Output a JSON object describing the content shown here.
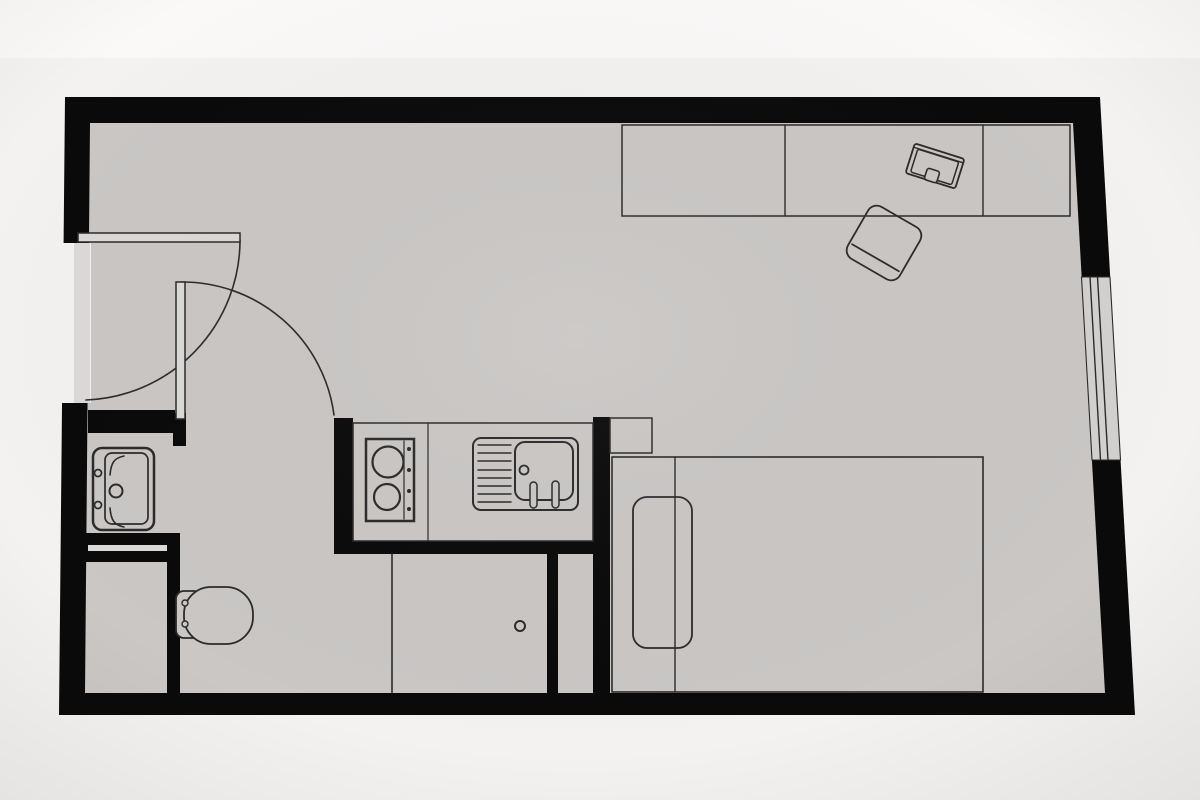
{
  "page": {
    "kind": "floor-plan-drawing",
    "text_content": "none"
  },
  "colors": {
    "background": "#f4f2f0",
    "backgroundTop": "#fbfaf9",
    "floor": "#cac7c5",
    "floorLight": "#dcdad8",
    "wall": "#0a0a0a",
    "line": "#2b2b2b",
    "windowGlass": "#d3d1cf"
  },
  "plan": {
    "rooms": [
      {
        "name": "main-room"
      },
      {
        "name": "entry-hall"
      },
      {
        "name": "bathroom"
      },
      {
        "name": "shower-area"
      },
      {
        "name": "kitchen"
      },
      {
        "name": "utility-niche"
      }
    ],
    "doors": [
      {
        "name": "entrance-door",
        "state": "open",
        "swing": "quarter-arc"
      },
      {
        "name": "bathroom-door",
        "state": "open",
        "swing": "quarter-arc"
      }
    ],
    "window": {
      "name": "window",
      "wall": "right"
    },
    "fixtures": [
      {
        "name": "washbasin"
      },
      {
        "name": "toilet"
      },
      {
        "name": "shower-screen"
      },
      {
        "name": "shower-drain"
      },
      {
        "name": "kitchen-counter"
      },
      {
        "name": "cooktop",
        "burners": 2
      },
      {
        "name": "kitchen-sink"
      },
      {
        "name": "side-table"
      },
      {
        "name": "bed"
      },
      {
        "name": "pillow"
      },
      {
        "name": "desk"
      },
      {
        "name": "laptop"
      },
      {
        "name": "desk-chair"
      }
    ]
  }
}
